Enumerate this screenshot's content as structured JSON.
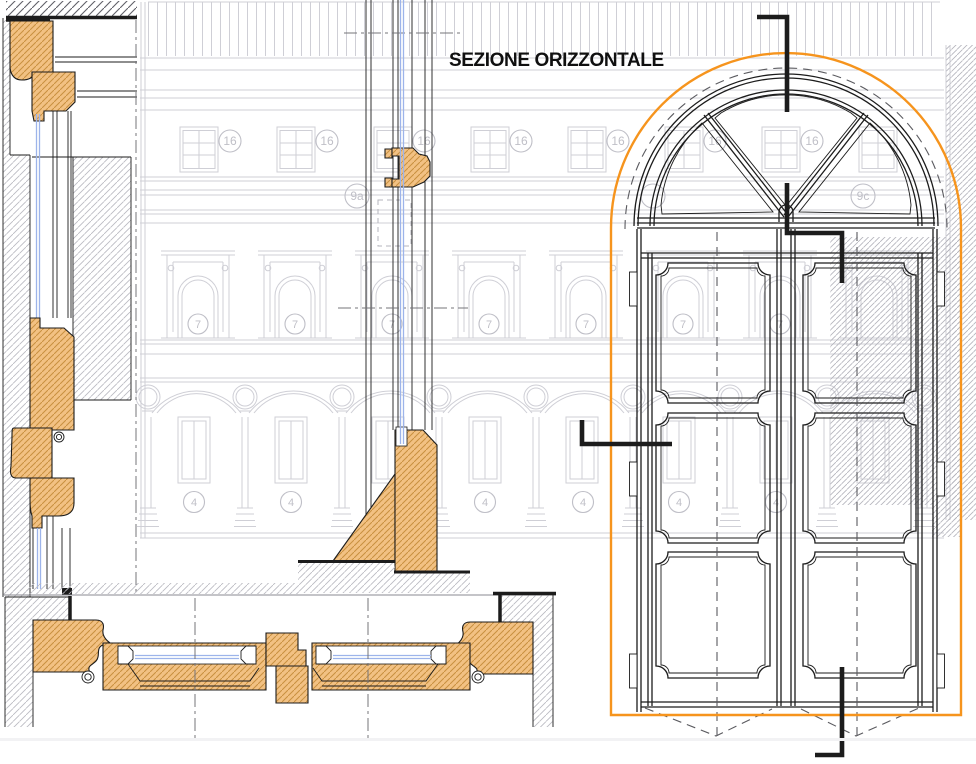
{
  "title": "SEZIONE ORIZZONTALE",
  "labels": {
    "n16": "16",
    "n7": "7",
    "n4": "4",
    "n9a": "9a",
    "n9c": "9c"
  },
  "colors": {
    "orange": "#F6941D",
    "wood_fill": "#F2C183",
    "wood_hatch": "#C8903F",
    "glass": "#9DB4EA",
    "faint": "#CFCFD6",
    "label": "#BFBFC7",
    "dark": "#1C1C1C",
    "masonry_hatch": "#B9B9C0",
    "masonry_dark": "#606068",
    "light_hatch": "#B3B3BB"
  }
}
